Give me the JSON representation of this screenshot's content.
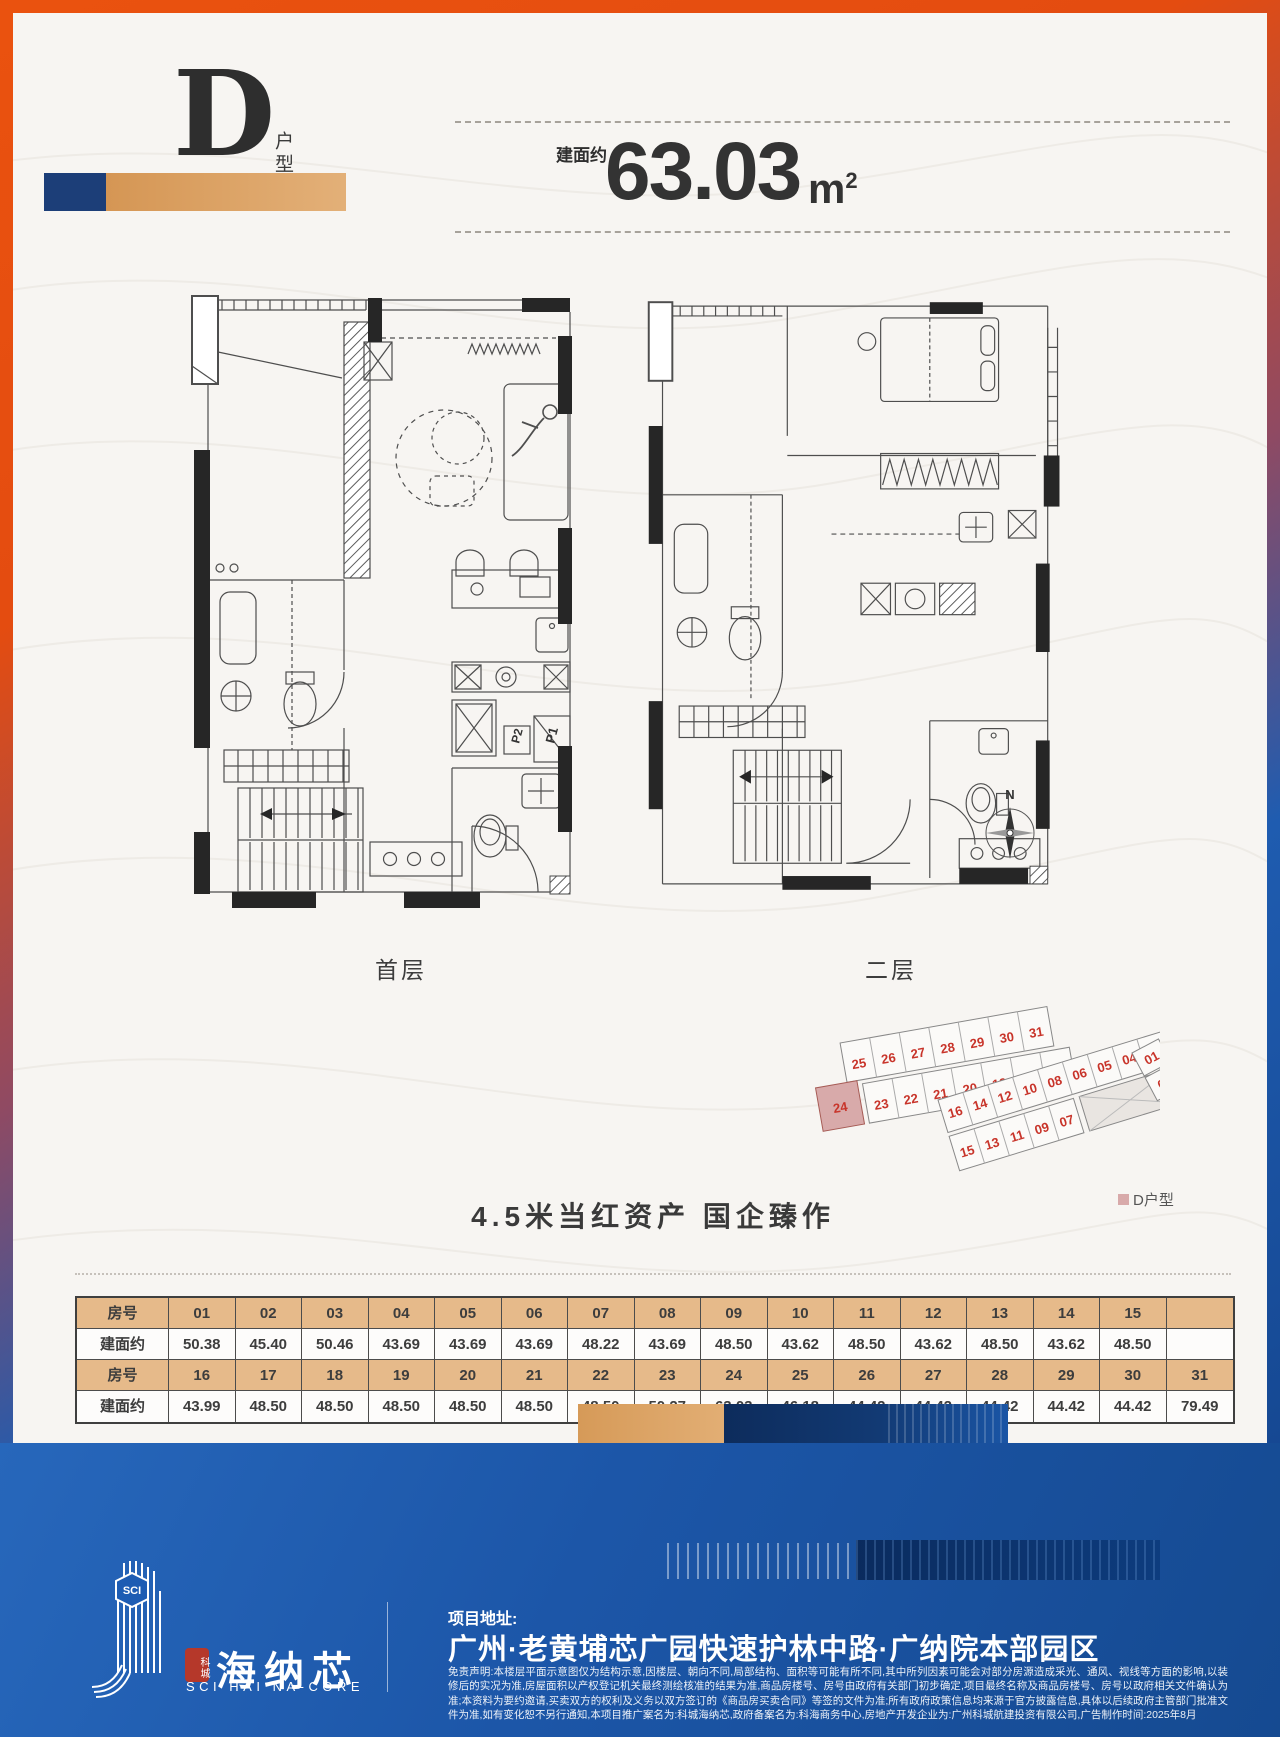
{
  "header": {
    "unit_letter": "D",
    "unit_suffix": "户型",
    "area_label": "建面约",
    "area_value": "63.03",
    "area_unit": "m",
    "area_exponent": "2"
  },
  "plans": {
    "floor1_label": "首层",
    "floor2_label": "二层",
    "compass_north": "N",
    "p1_label": "P1",
    "p2_label": "P2"
  },
  "site_plan": {
    "legend_label": "D户型",
    "highlight_unit": "24",
    "highlight_color": "#d8aaaa",
    "left_top": [
      "25",
      "26",
      "27",
      "28",
      "29",
      "30",
      "31"
    ],
    "left_bottom": [
      "23",
      "22",
      "21",
      "20",
      "19",
      "18",
      "17"
    ],
    "right_top": [
      "16",
      "14",
      "12",
      "10",
      "08",
      "06",
      "05",
      "04",
      "02"
    ],
    "right_bottom": [
      "15",
      "13",
      "11",
      "09",
      "07"
    ],
    "right_end": [
      "01",
      "03"
    ]
  },
  "tagline": "4.5米当红资产 国企臻作",
  "table": {
    "header_bg": "#e6ba8a",
    "rows": [
      {
        "label": "房号",
        "values": [
          "01",
          "02",
          "03",
          "04",
          "05",
          "06",
          "07",
          "08",
          "09",
          "10",
          "11",
          "12",
          "13",
          "14",
          "15",
          ""
        ]
      },
      {
        "label": "建面约",
        "values": [
          "50.38",
          "45.40",
          "50.46",
          "43.69",
          "43.69",
          "43.69",
          "48.22",
          "43.69",
          "48.50",
          "43.62",
          "48.50",
          "43.62",
          "48.50",
          "43.62",
          "48.50",
          ""
        ]
      },
      {
        "label": "房号",
        "values": [
          "16",
          "17",
          "18",
          "19",
          "20",
          "21",
          "22",
          "23",
          "24",
          "25",
          "26",
          "27",
          "28",
          "29",
          "30",
          "31"
        ]
      },
      {
        "label": "建面约",
        "values": [
          "43.99",
          "48.50",
          "48.50",
          "48.50",
          "48.50",
          "48.50",
          "48.50",
          "50.27",
          "63.03",
          "46.18",
          "44.42",
          "44.42",
          "44.42",
          "44.42",
          "44.42",
          "79.49"
        ]
      }
    ]
  },
  "footer": {
    "logo_badge": "SCI",
    "logo_seal": "科城",
    "logo_name_cn": "海纳芯",
    "logo_name_en": "SCI HAI NA-CORE",
    "address_label": "项目地址:",
    "address": "广州·老黄埔芯广园快速护林中路·广纳院本部园区",
    "disclaimer": "免责声明:本楼层平面示意图仅为结构示意,因楼层、朝向不同,局部结构、面积等可能有所不同,其中所列因素可能会对部分房源造成采光、通风、视线等方面的影响,以装修后的实况为准,房屋面积以产权登记机关最终测绘核准的结果为准,商品房楼号、房号由政府有关部门初步确定,项目最终名称及商品房楼号、房号以政府相关文件确认为准;本资料为要约邀请,买卖双方的权利及义务以双方签订的《商品房买卖合同》等签的文件为准;所有政府政策信息均来源于官方披露信息,具体以后续政府主管部门批准文件为准,如有变化恕不另行通知,本项目推广案名为:科城海纳芯,政府备案名为:科海商务中心,房地产开发企业为:广州科城航建投资有限公司,广告制作时间:2025年8月"
  }
}
